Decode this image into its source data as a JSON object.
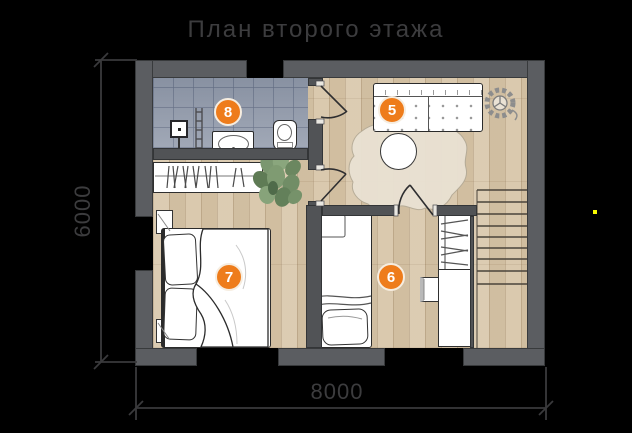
{
  "title": "План второго этажа",
  "dimensions": {
    "horizontal_label": "8000",
    "vertical_label": "6000"
  },
  "room_badges": [
    {
      "label": "5"
    },
    {
      "label": "6"
    },
    {
      "label": "7"
    },
    {
      "label": "8"
    }
  ],
  "colors": {
    "background": "#000000",
    "title-text": "#3c3c3e",
    "dimension-text": "#3c3c3e",
    "dimension-line": "#3a3a3c",
    "badge-orange": "#ee7c1b",
    "badge-border": "#f6ede0",
    "wall-outer": "#5b5d61",
    "wall-inner": "#515356",
    "floor-wood": "#d8c7ab",
    "floor-tile": "#9ba3b2",
    "outline-dark": "#2b2b2b",
    "rug-beige": "#e9e1d2",
    "indicator-yellow": "#f8fb00"
  }
}
